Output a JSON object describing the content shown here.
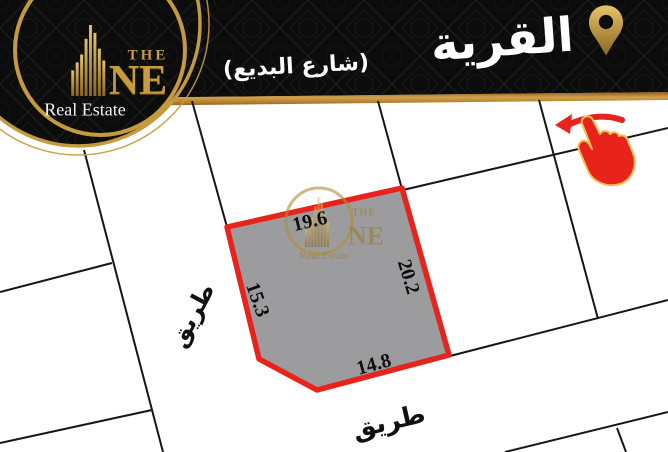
{
  "header": {
    "title": "القرية",
    "subtitle": "(شارع البديع)"
  },
  "brand": {
    "word_the": "THE",
    "word_ne": "NE",
    "tagline": "Real Estate"
  },
  "plot": {
    "side_top": "19.6",
    "side_right": "20.2",
    "side_left": "15.3",
    "side_bottom": "14.8"
  },
  "roads": {
    "left_label": "طريق",
    "bottom_label": "طريق"
  },
  "icons": {
    "location_pin": "location-pin-icon",
    "swipe_hand": "swipe-left-hand-icon",
    "building": "building-icon",
    "logo_ring": "logo-ring-icon"
  },
  "colors": {
    "gold": "#c3923a",
    "gold_band": "#b5812f",
    "red": "#e8231c",
    "plot_gray": "#9c9c9e",
    "header_black": "#0b0b0b",
    "line_black": "#161616"
  }
}
